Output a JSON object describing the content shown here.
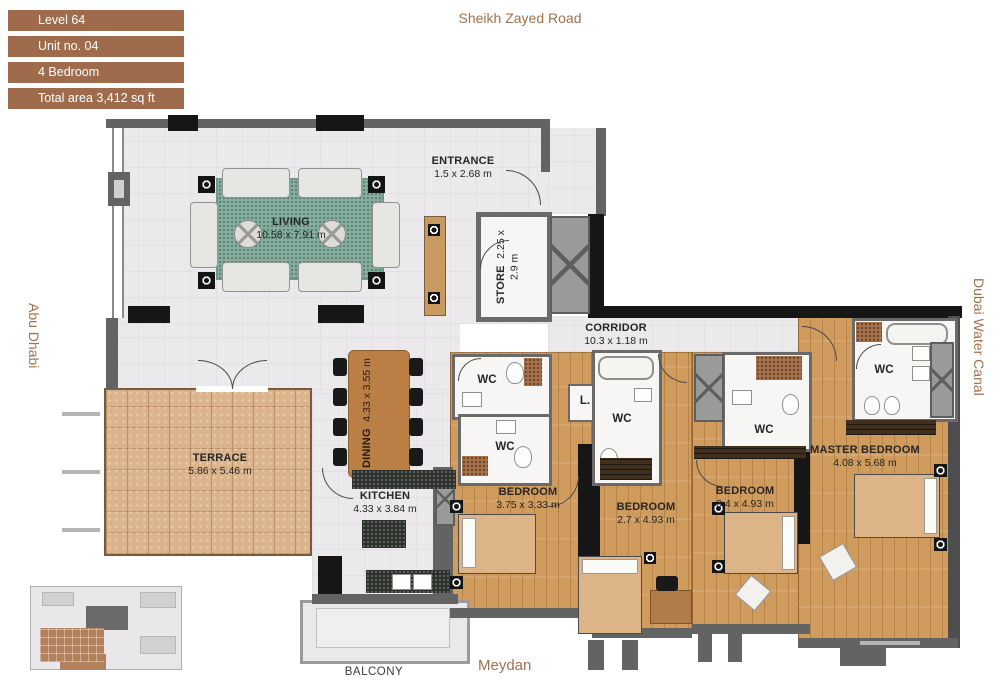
{
  "info_panel": {
    "items": [
      "Level 64",
      "Unit no. 04",
      "4 Bedroom",
      "Total area 3,412 sq ft"
    ]
  },
  "context_labels": {
    "top": "Sheikh Zayed Road",
    "left": "Abu Dhabi",
    "right": "Dubai Water Canal",
    "bottom": "Meydan"
  },
  "rooms": {
    "living": {
      "name": "LIVING",
      "dims": "10.58 x 7.91 m"
    },
    "entrance": {
      "name": "ENTRANCE",
      "dims": "1.5 x 2.68 m"
    },
    "store": {
      "name": "STORE",
      "dims": "2.25 x 2.9 m"
    },
    "corridor": {
      "name": "CORRIDOR",
      "dims": "10.3 x 1.18 m"
    },
    "dining": {
      "name": "DINING",
      "dims": "4.33 x 3.55 m"
    },
    "terrace": {
      "name": "TERRACE",
      "dims": "5.86 x 5.46 m"
    },
    "kitchen": {
      "name": "KITCHEN",
      "dims": "4.33 x 3.84 m"
    },
    "bedroom1": {
      "name": "BEDROOM",
      "dims": "3.75 x 3.33 m"
    },
    "bedroom2": {
      "name": "BEDROOM",
      "dims": "2.7 x 4.93 m"
    },
    "bedroom3": {
      "name": "BEDROOM",
      "dims": "3.4 x 4.93 m"
    },
    "master_bedroom": {
      "name": "MASTER BEDROOM",
      "dims": "4.08 x 5.68 m"
    },
    "balcony": {
      "name": "BALCONY"
    }
  },
  "labels": {
    "wc": "WC",
    "lift": "L."
  },
  "colors": {
    "accent_brown": "#9e6b4c",
    "context_text": "#a0714f",
    "wall_gray": "#636363",
    "column_black": "#161616",
    "wood_floor": "#d09c5e",
    "terrace_tile": "#dcb48c",
    "rug_green": "#87ae9f"
  }
}
